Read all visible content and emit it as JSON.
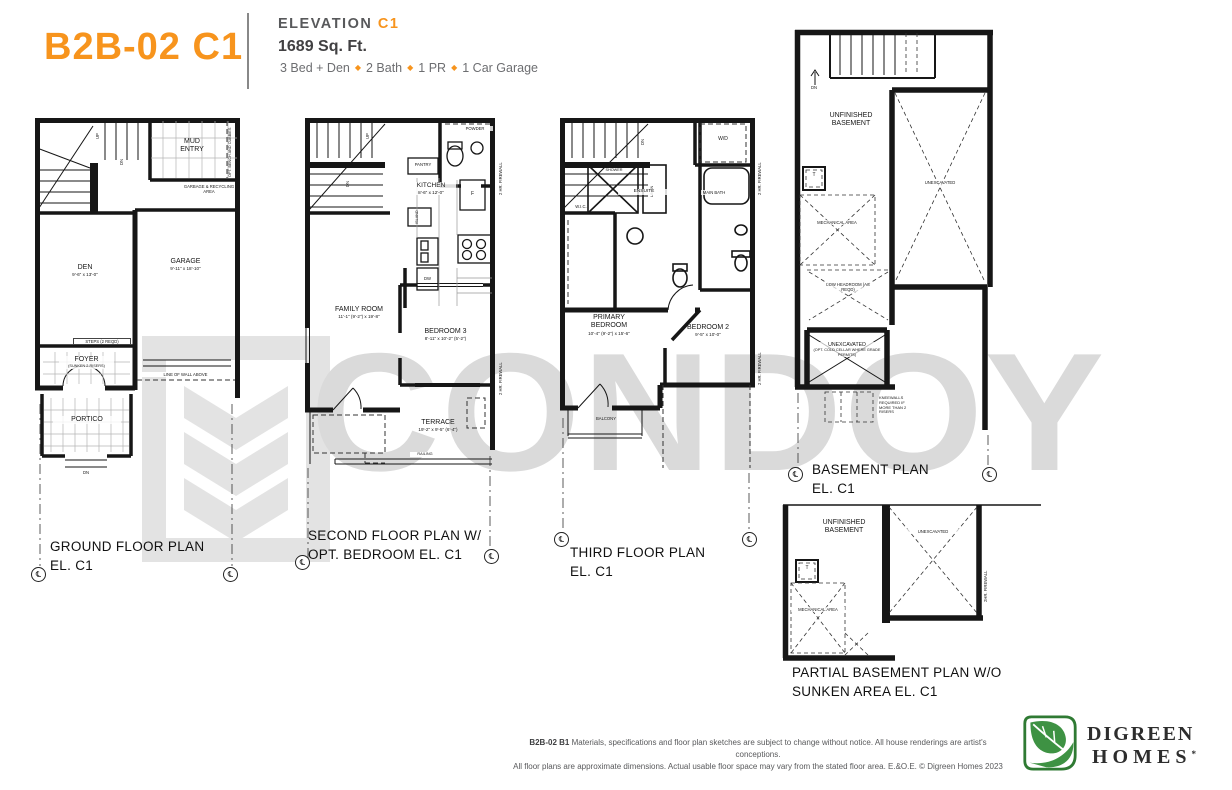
{
  "header": {
    "model": "B2B-02 C1",
    "elevation_label": "ELEVATION",
    "elevation_value": "C1",
    "area": "1689 Sq. Ft.",
    "specs": [
      "3 Bed + Den",
      "2 Bath",
      "1 PR",
      "1 Car Garage"
    ],
    "separator": "◆",
    "accent": "#F7941D"
  },
  "watermark": {
    "text": "CONDOY"
  },
  "symbols": {
    "centerline": "℄"
  },
  "plans": {
    "ground": {
      "title": "GROUND FLOOR PLAN",
      "subtitle": "EL. C1",
      "labels": {
        "up": "UP",
        "dn": "DN",
        "mud_entry": "MUD ENTRY",
        "opt_bench": "OPT. BENCH AND CUBBIES",
        "garbage": "GARBAGE & RECYCLING AREA",
        "den_name": "DEN",
        "den_dims": "9'-6\" x 13'-0\"",
        "garage_name": "GARAGE",
        "garage_dims": "9'-11\" x 18'-10\"",
        "steps": "STEPS (2 REQD)",
        "foyer_name": "FOYER",
        "foyer_note": "(SUNKEN 2 RISERS)",
        "line_of_wall": "LINE OF WALL ABOVE",
        "portico_name": "PORTICO"
      }
    },
    "second": {
      "title": "SECOND FLOOR PLAN W/",
      "subtitle": "OPT. BEDROOM EL. C1",
      "labels": {
        "up": "UP",
        "dn": "DN",
        "powder": "POWDER",
        "pantry": "PANTRY",
        "kitchen_name": "KITCHEN",
        "kitchen_dims": "8'-6\" x 12'-0\"",
        "island": "ISLAND",
        "fridge": "F",
        "dw": "DW",
        "family_name": "FAMILY ROOM",
        "family_dims": "11'-1\" (9'-2\") x 19'-8\"",
        "bedroom3_name": "BEDROOM 3",
        "bedroom3_dims": "8'-11\" x 10'-2\" (5'-2\")",
        "terrace_name": "TERRACE",
        "terrace_dims": "19'-2\" x 9'-5\" (6'-4\")",
        "railing": "RAILING",
        "firewall": "2 HR. FIREWALL"
      }
    },
    "third": {
      "title": "THIRD FLOOR PLAN",
      "subtitle": "EL. C1",
      "labels": {
        "dn": "DN",
        "wd": "W/D",
        "shower": "SHOWER",
        "linen": "LINEN",
        "ensuite": "ENSUITE",
        "wic": "W.I.C.",
        "main_bath": "MAIN BATH",
        "primary_name": "PRIMARY BEDROOM",
        "primary_dims": "10'-4\" (9'-2\") x 15'-6\"",
        "bedroom2_name": "BEDROOM 2",
        "bedroom2_dims": "9'-5\" x 10'-0\"",
        "balcony": "BALCONY",
        "firewall": "2 HR. FIREWALL"
      }
    },
    "basement": {
      "title": "BASEMENT PLAN",
      "subtitle": "EL. C1",
      "labels": {
        "dn": "DN",
        "unfinished": "UNFINISHED BASEMENT",
        "tank": "T",
        "mechanical": "MECHANICAL AREA",
        "unexcavated": "UNEXCAVATED",
        "low_headroom": "LOW HEADROOM (AS REQD)",
        "cold_cellar_name": "UNEXCAVATED",
        "cold_cellar_note": "(OPT. COLD CELLAR WHERE GRADE PERMITS)",
        "kneewall": "KNEEWALLS REQUIRED IF MORE THAN 2 RISERS"
      }
    },
    "partial": {
      "title": "PARTIAL BASEMENT PLAN W/O",
      "subtitle": "SUNKEN AREA EL. C1",
      "labels": {
        "unfinished": "UNFINISHED BASEMENT",
        "tank": "T",
        "mechanical": "MECHANICAL AREA",
        "unexcavated": "UNEXCAVATED",
        "firewall": "2HR. FIREWALL"
      }
    }
  },
  "footer": {
    "disclaimer_bold": "B2B-02 B1",
    "disclaimer_1": "Materials, specifications and floor plan sketches are subject to change without notice. All house renderings are artist's conceptions.",
    "disclaimer_2": "All floor plans are approximate dimensions. Actual usable floor space may vary from the stated floor area. E.&O.E. © Digreen Homes 2023",
    "logo_line1": "DIGREEN",
    "logo_line2": "HOMES",
    "logo_mark": "*"
  }
}
